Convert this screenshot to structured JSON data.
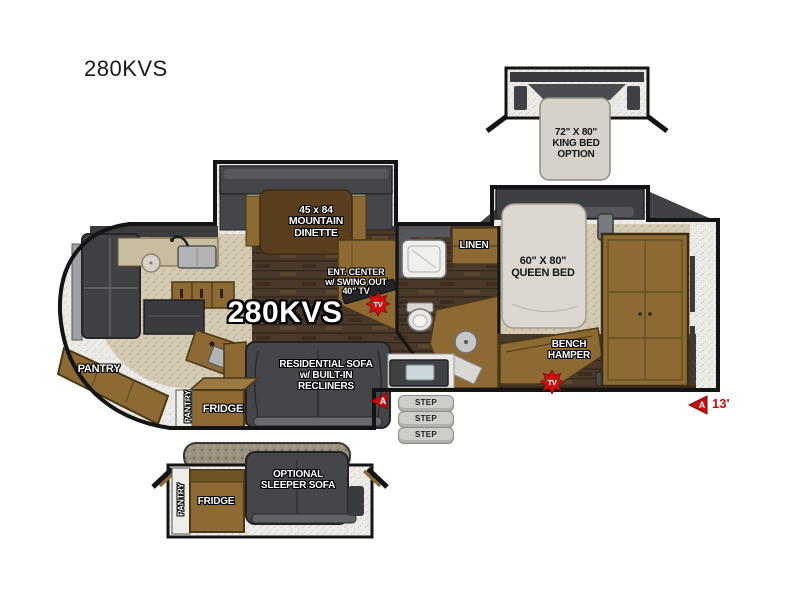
{
  "page": {
    "title": "280KVS"
  },
  "colors": {
    "wall": "#141414",
    "wood": "#8d6a33",
    "dark_furniture": "#45464a",
    "mattress": "#dcd8d1",
    "carpet": "#d5cbb4",
    "accent_red": "#c41010"
  },
  "labels": {
    "title": "280KVS",
    "model": "280KVS",
    "king_bed": {
      "line1": "72\" X 80\"",
      "line2": "KING BED",
      "line3": "OPTION"
    },
    "dinette": {
      "line1": "45 x 84",
      "line2": "MOUNTAIN",
      "line3": "DINETTE"
    },
    "ent_center": {
      "line1": "ENT. CENTER",
      "line2": "w/ SWING OUT",
      "line3": "40\" TV"
    },
    "queen_bed": {
      "line1": "60\" X 80\"",
      "line2": "QUEEN BED"
    },
    "linen": "LINEN",
    "bench": {
      "line1": "BENCH",
      "line2": "HAMPER"
    },
    "pantry_main": "PANTRY",
    "pantry_slide": "PANTRY",
    "fridge_main": "FRIDGE",
    "sofa": {
      "line1": "RESIDENTIAL SOFA",
      "line2": "w/ BUILT-IN",
      "line3": "RECLINERS"
    },
    "steps": [
      "STEP",
      "STEP",
      "STEP"
    ],
    "tv_badge": "TV",
    "awning_door": "A",
    "awning_rear": "A",
    "awning_length": "13'",
    "inset": {
      "pantry": "PANTRY",
      "fridge": "FRIDGE",
      "sofa_line1": "OPTIONAL",
      "sofa_line2": "SLEEPER SOFA"
    }
  }
}
